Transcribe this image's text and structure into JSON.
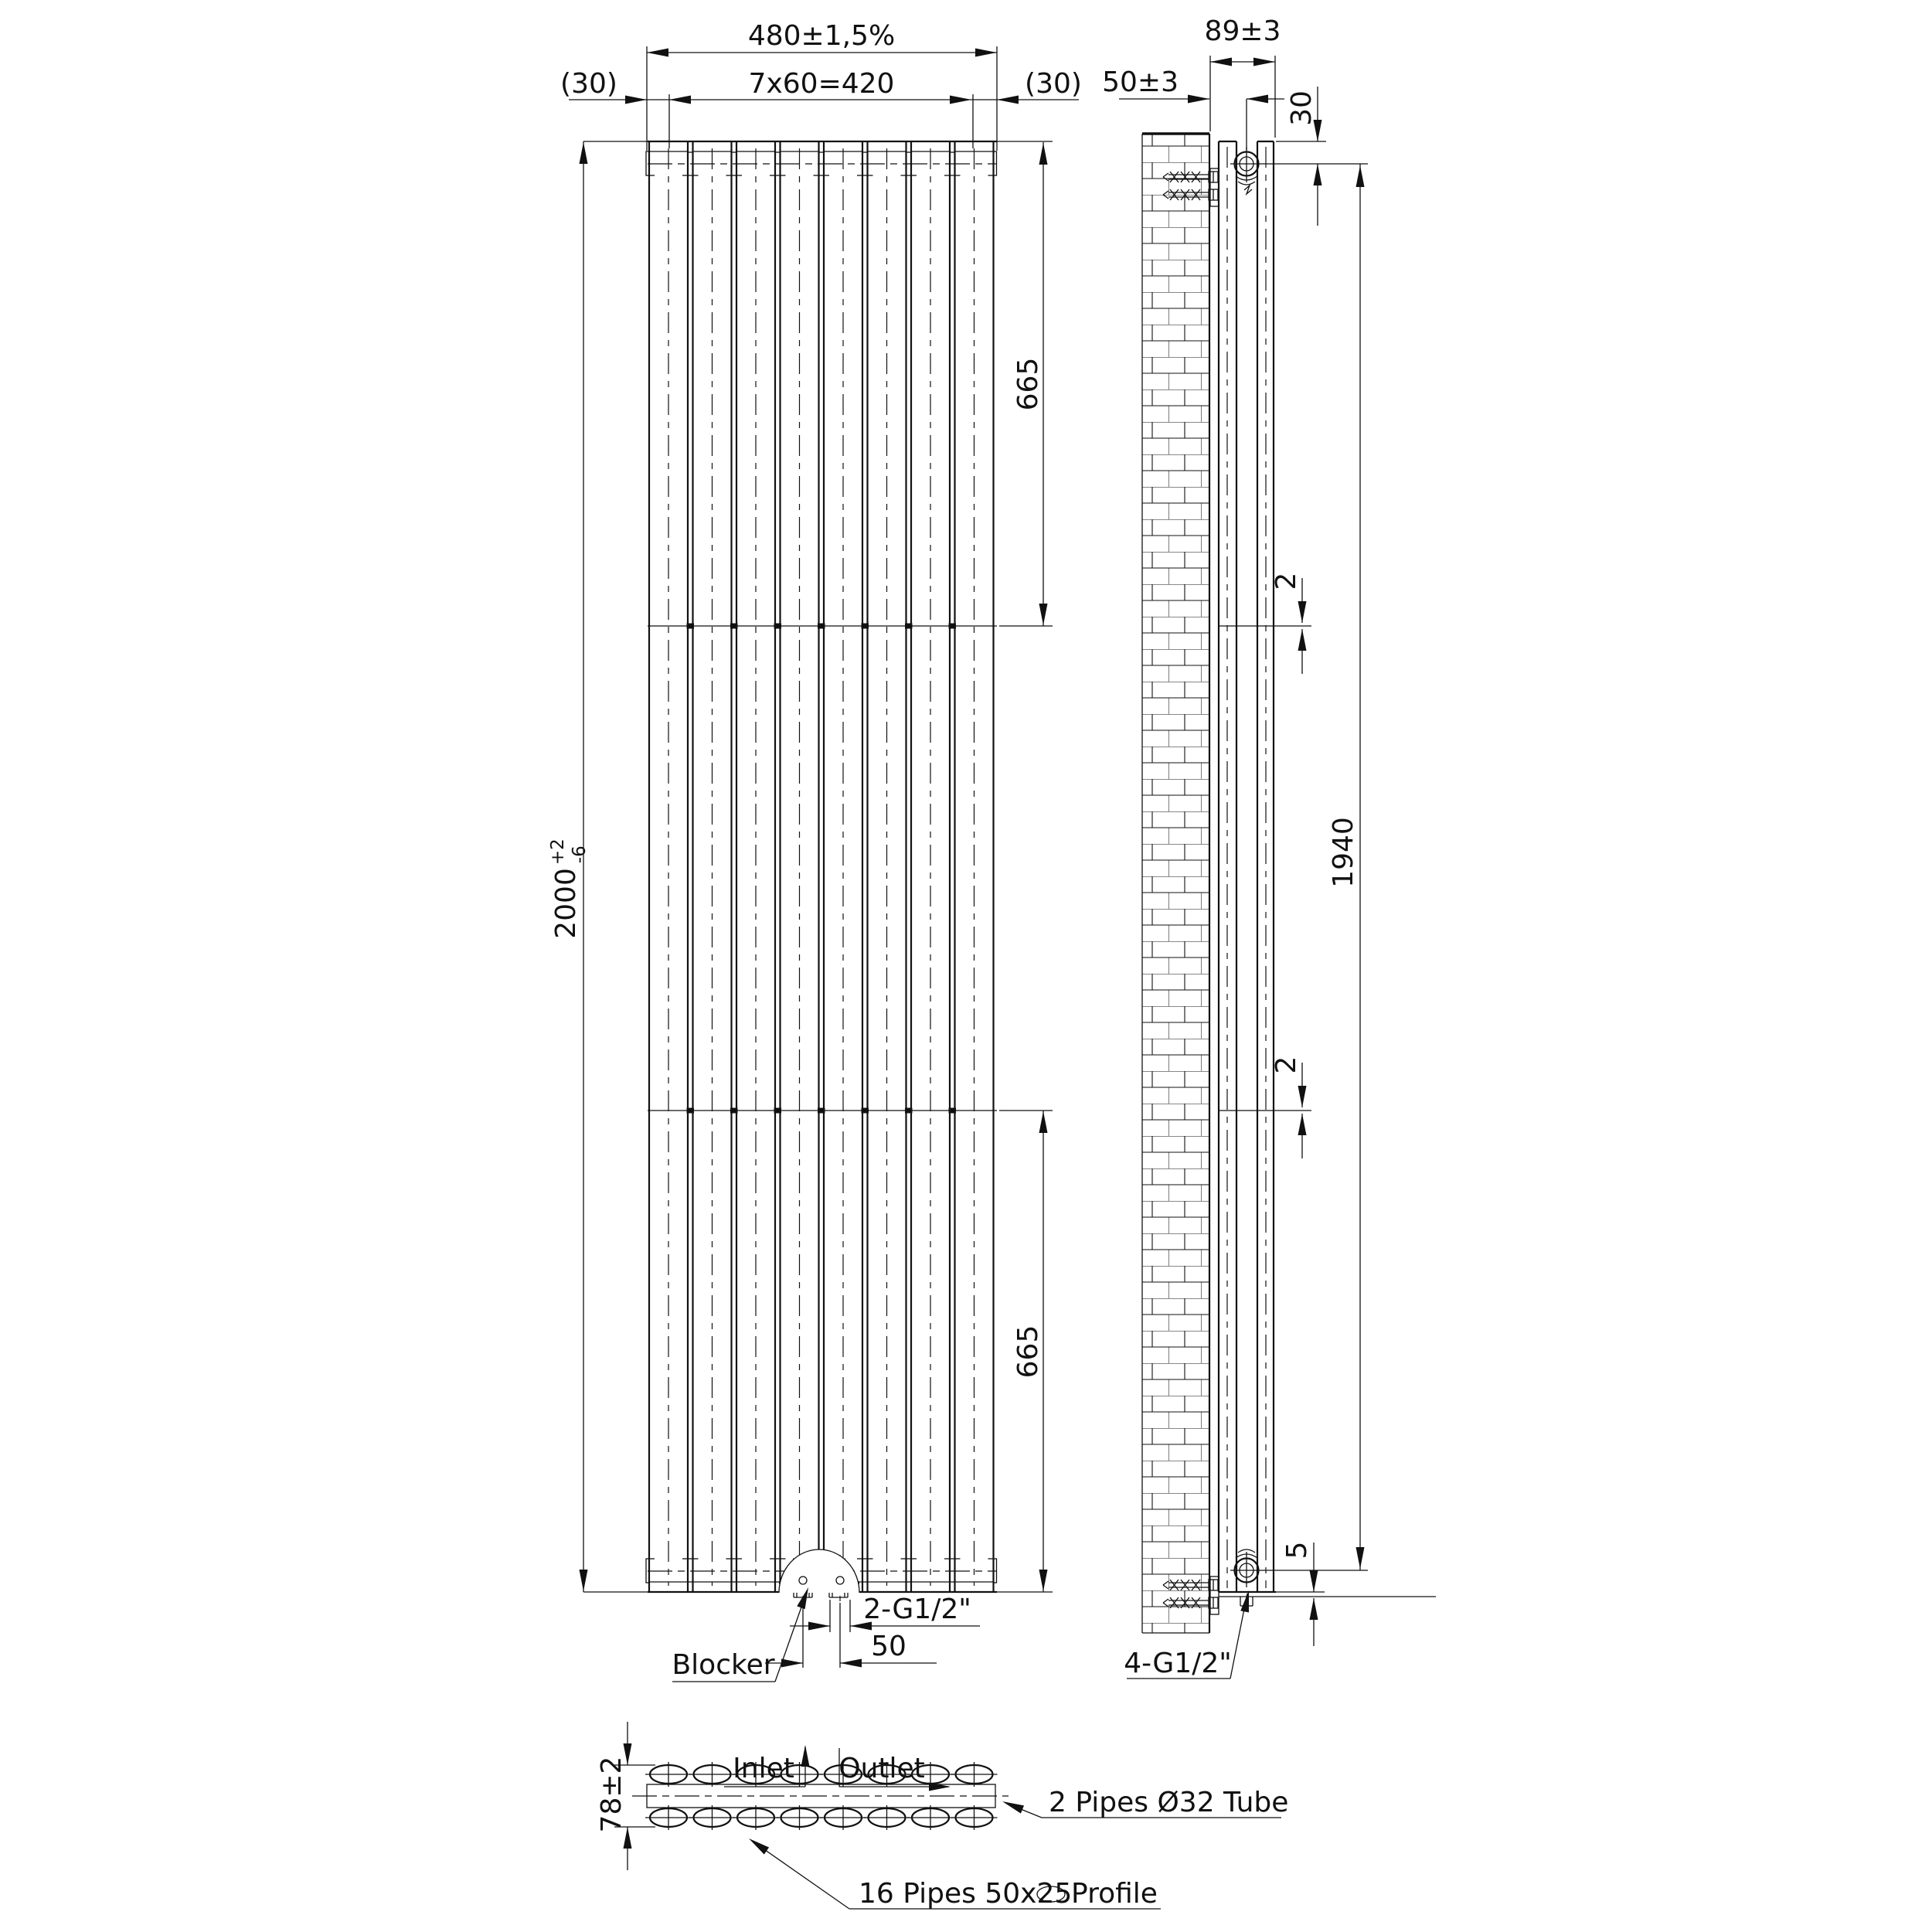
{
  "drawing_type": "radiator engineering drawing, three orthographic views",
  "colors": {
    "ink": "#111111",
    "paper": "#ffffff"
  },
  "front": {
    "dim_total_width": "480±1,5%",
    "dim_pitch": "7x60=420",
    "dim_end_left": "(30)",
    "dim_end_right": "(30)",
    "dim_height": "2000",
    "dim_height_tol_plus": "+2",
    "dim_height_tol_minus": "-6",
    "dim_segment_top": "665",
    "dim_segment_bottom": "665",
    "label_blocker": "Blocker",
    "dim_ports": "2-G1/2\"",
    "dim_port_spacing": "50",
    "label_inlet": "Inlet",
    "label_outlet": "Outlet"
  },
  "side": {
    "dim_depth": "89±3",
    "dim_wall_to_pipe": "50±3",
    "dim_top_offset": "30",
    "dim_seam_upper": "2",
    "dim_seam_lower": "2",
    "dim_connection_centers": "1940",
    "dim_bottom_gap": "5",
    "label_connections": "4-G1/2\""
  },
  "section": {
    "dim_thickness": "78±2",
    "label_tubes": "2 Pipes Ø32 Tube",
    "label_pipes_prefix": "16 Pipes 50x25",
    "label_pipes_suffix": "Profile"
  }
}
